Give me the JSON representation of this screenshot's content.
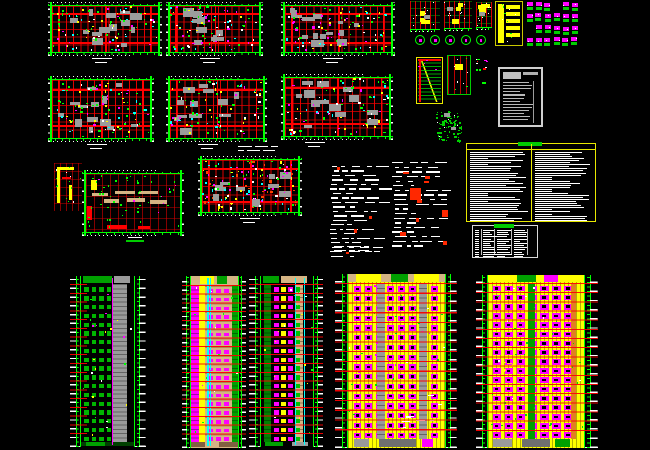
{
  "app": {
    "name": "cad-drawing-sheet",
    "description": "architectural CAD sheet: residential floor plans, detail drawings, schedule tables and five high-rise building elevations on black model space",
    "canvas_bg": "#000000",
    "canvas_width": 650,
    "canvas_height": 450
  },
  "palette": {
    "red": "#ff0000",
    "green": "#00ff00",
    "dark_green": "#008000",
    "magenta": "#ff00ff",
    "yellow": "#ffff00",
    "cyan": "#00ffff",
    "white": "#ffffff",
    "gray": "#9a9a9a",
    "tan": "#d4b483",
    "orange": "#e08020"
  },
  "sheet": {
    "blocks": [
      {
        "id": "floor-plan-1",
        "type": "plan",
        "x": 48,
        "y": 2,
        "w": 114,
        "h": 64,
        "seed": 11,
        "cols": 15,
        "rows": 6,
        "blobs": 14,
        "speckles": 85,
        "title": {
          "dx": 40
        }
      },
      {
        "id": "floor-plan-2",
        "type": "plan",
        "x": 166,
        "y": 2,
        "w": 97,
        "h": 64,
        "seed": 12,
        "cols": 13,
        "rows": 6,
        "blobs": 12,
        "speckles": 75,
        "title": {
          "dx": 30
        }
      },
      {
        "id": "floor-plan-3",
        "type": "plan",
        "x": 281,
        "y": 2,
        "w": 114,
        "h": 64,
        "seed": 13,
        "cols": 15,
        "rows": 6,
        "blobs": 14,
        "speckles": 85,
        "title": {
          "dx": 38
        }
      },
      {
        "id": "floor-plan-4",
        "type": "plan",
        "x": 48,
        "y": 76,
        "w": 106,
        "h": 76,
        "seed": 14,
        "cols": 14,
        "rows": 7,
        "blobs": 13,
        "speckles": 90,
        "title": {
          "dx": 35
        }
      },
      {
        "id": "floor-plan-5",
        "type": "plan",
        "x": 166,
        "y": 76,
        "w": 101,
        "h": 76,
        "seed": 15,
        "cols": 13,
        "rows": 7,
        "blobs": 12,
        "speckles": 80,
        "title": {
          "dx": 28
        }
      },
      {
        "id": "floor-plan-6",
        "type": "plan",
        "x": 281,
        "y": 74,
        "w": 112,
        "h": 76,
        "seed": 16,
        "cols": 14,
        "rows": 7,
        "blobs": 13,
        "speckles": 85,
        "title": {
          "dx": 20
        }
      },
      {
        "id": "roof-plan",
        "type": "roofplan",
        "x": 82,
        "y": 170,
        "w": 102,
        "h": 76,
        "seed": 17,
        "title": {
          "dx": 40,
          "green": true
        }
      },
      {
        "id": "floor-plan-7",
        "type": "plan",
        "x": 198,
        "y": 156,
        "w": 104,
        "h": 70,
        "seed": 18,
        "cols": 14,
        "rows": 6,
        "blobs": 10,
        "speckles": 130,
        "speckleColors": [
          "#ff00ff",
          "#00ffff",
          "#ffff00",
          "#00ff00",
          "#ffffff",
          "#ff4000"
        ],
        "title": {
          "dx": 38
        }
      },
      {
        "id": "unit-detail",
        "type": "unitdetail",
        "x": 54,
        "y": 163,
        "w": 28,
        "h": 48,
        "seed": 19
      },
      {
        "id": "section-detail-1",
        "type": "section",
        "x": 410,
        "y": 1,
        "w": 30,
        "h": 31,
        "seed": 21
      },
      {
        "id": "section-detail-2",
        "type": "section",
        "x": 444,
        "y": 1,
        "w": 28,
        "h": 30,
        "seed": 22
      },
      {
        "id": "section-detail-3",
        "type": "section",
        "x": 476,
        "y": 2,
        "w": 16,
        "h": 28,
        "seed": 23
      },
      {
        "id": "circle-details",
        "type": "circles",
        "x": 413,
        "y": 33,
        "w": 76,
        "h": 15,
        "seed": 24,
        "n": 5
      },
      {
        "id": "stair-core-detail",
        "type": "ydetail",
        "x": 495,
        "y": 1,
        "w": 28,
        "h": 45,
        "seed": 25
      },
      {
        "id": "connector-details",
        "type": "cluster",
        "x": 526,
        "y": 1,
        "w": 54,
        "h": 48,
        "seed": 26,
        "rows": 4,
        "cols": 6
      },
      {
        "id": "stair-section-detail",
        "type": "stair",
        "x": 416,
        "y": 57,
        "w": 27,
        "h": 47,
        "seed": 27
      },
      {
        "id": "wall-detail",
        "type": "detailB",
        "x": 447,
        "y": 55,
        "w": 24,
        "h": 40,
        "seed": 28
      },
      {
        "id": "misc-marks",
        "type": "smallbits",
        "x": 472,
        "y": 58,
        "w": 20,
        "h": 36,
        "seed": 29
      },
      {
        "id": "core-plan-detail",
        "type": "greencluster",
        "x": 436,
        "y": 111,
        "w": 27,
        "h": 32,
        "seed": 30
      },
      {
        "id": "title-block-table",
        "type": "wtable",
        "x": 498,
        "y": 67,
        "w": 45,
        "h": 60,
        "seed": 31
      },
      {
        "id": "notes-table",
        "type": "ytable",
        "x": 466,
        "y": 143,
        "w": 130,
        "h": 79,
        "seed": 32
      },
      {
        "id": "schedule-table",
        "type": "stable",
        "x": 472,
        "y": 225,
        "w": 66,
        "h": 33,
        "seed": 33
      },
      {
        "id": "spec-text-1",
        "type": "sched",
        "x": 330,
        "y": 166,
        "w": 58,
        "h": 94,
        "seed": 34,
        "rows": 21
      },
      {
        "id": "spec-text-2",
        "type": "sched",
        "x": 392,
        "y": 162,
        "w": 66,
        "h": 88,
        "seed": 35,
        "rows": 19,
        "bigRed": true
      },
      {
        "id": "note-line-1",
        "type": "noterow",
        "x": 238,
        "y": 146,
        "w": 36,
        "h": 8,
        "seed": 36
      },
      {
        "id": "note-line-2",
        "type": "noterow",
        "x": 334,
        "y": 246,
        "w": 54,
        "h": 11,
        "seed": 37
      },
      {
        "id": "elevation-1",
        "type": "elev",
        "x": 70,
        "y": 276,
        "w": 76,
        "h": 171,
        "seed": 41,
        "floors": 18,
        "tickL": 11,
        "tickR": 12,
        "par": 8,
        "baseH": 5,
        "wall": "#000000",
        "cols": 4,
        "win": "#00b400",
        "winL": 0.03,
        "winR": 0.4,
        "winH": 0.5,
        "shafts": [
          {
            "x": 0.6,
            "w": 0.26,
            "c": "#9a9a9a",
            "tex": 1
          }
        ],
        "lines": [
          {
            "x": 0.585,
            "c": "#ff00ff"
          }
        ],
        "redSpan": "left",
        "parapet": [
          {
            "x": 0.04,
            "w": 0.55,
            "c": "#00a000"
          },
          {
            "x": 0.62,
            "w": 0.3,
            "c": "#9a9a9a"
          }
        ],
        "base": [
          {
            "x": 0,
            "w": 1,
            "c": "#004000"
          },
          {
            "x": 0.1,
            "w": 0.35,
            "c": "#00a000"
          }
        ],
        "speck": 25,
        "speckColors": [
          "#ffff00",
          "#ff00ff",
          "#ffffff",
          "#00ff00"
        ]
      },
      {
        "id": "elevation-2",
        "type": "elev",
        "x": 182,
        "y": 276,
        "w": 64,
        "h": 172,
        "seed": 42,
        "floors": 18,
        "tickL": 9,
        "tickR": 8,
        "par": 9,
        "baseH": 6,
        "wall": "#d4b483",
        "band": "#b08850",
        "bandH": 2,
        "cols": 3,
        "win": "#ff00ff",
        "winL": 0.33,
        "winR": 0.15,
        "winH": 0.42,
        "shafts": [
          {
            "x": 0.01,
            "w": 0.15,
            "c": "#ff00ff",
            "tex": 1
          },
          {
            "x": 0.17,
            "w": 0.13,
            "c": "#ffff00"
          },
          {
            "x": 0.87,
            "w": 0.13,
            "c": "#00a000",
            "tex": 1
          }
        ],
        "lines": [
          {
            "x": 0.35,
            "c": "#00ffff"
          },
          {
            "x": 0.41,
            "c": "#00ffff"
          }
        ],
        "parapet": [
          {
            "x": 0,
            "w": 1,
            "c": "#d4b483"
          },
          {
            "x": 0.2,
            "w": 0.3,
            "c": "#ffff00"
          },
          {
            "x": 0.55,
            "w": 0.22,
            "c": "#00a000"
          }
        ],
        "base": [
          {
            "x": 0,
            "w": 1,
            "c": "#806040"
          },
          {
            "x": 0.3,
            "w": 0.3,
            "c": "#d4b483"
          }
        ],
        "speck": 20,
        "speckColors": [
          "#00ff00",
          "#ffffff",
          "#ff00ff"
        ]
      },
      {
        "id": "elevation-3",
        "type": "elev",
        "x": 249,
        "y": 276,
        "w": 74,
        "h": 171,
        "seed": 43,
        "floors": 18,
        "tickL": 12,
        "tickR": 10,
        "par": 8,
        "baseH": 5,
        "wall": "#000000",
        "cols": 4,
        "colColors": [
          "#ff00ff",
          "#ffff00",
          "#ff00ff",
          "#00c000"
        ],
        "winL": 0.23,
        "winR": 0.23,
        "winH": 0.5,
        "shafts": [
          {
            "x": 0.06,
            "w": 0.14,
            "c": "#008000",
            "tex": 1
          },
          {
            "x": 0.67,
            "w": 0.13,
            "c": "#d4b483",
            "tex": 1
          }
        ],
        "lines": [
          {
            "x": 0.645,
            "c": "#00ffff"
          },
          {
            "x": 0.82,
            "c": "#00ffff"
          }
        ],
        "parapet": [
          {
            "x": 0.04,
            "w": 0.3,
            "c": "#00a000"
          },
          {
            "x": 0.38,
            "w": 0.5,
            "c": "#d4b483"
          }
        ],
        "base": [
          {
            "x": 0.08,
            "w": 0.35,
            "c": "#00a000"
          },
          {
            "x": 0.6,
            "w": 0.3,
            "c": "#9a9a9a"
          }
        ],
        "speck": 22,
        "speckColors": [
          "#00ff00",
          "#ffffff",
          "#ffff00"
        ]
      },
      {
        "id": "elevation-4",
        "type": "elev",
        "x": 335,
        "y": 274,
        "w": 122,
        "h": 174,
        "seed": 44,
        "floors": 16,
        "tickL": 13,
        "tickR": 12,
        "par": 9,
        "baseH": 9,
        "wall": "#ffff00",
        "wallTex": 1,
        "cols": 8,
        "win": "#ff00ff",
        "winInner": "#000000",
        "winL": 0.04,
        "winR": 0.05,
        "winH": 0.55,
        "shafts": [
          {
            "x": 0.3,
            "w": 0.08,
            "c": "#9a9a9a",
            "over": 1,
            "tex": 1
          },
          {
            "x": 0.73,
            "w": 0.08,
            "c": "#9a9a9a",
            "over": 1,
            "tex": 1
          }
        ],
        "lines": [],
        "parapet": [
          {
            "x": 0,
            "w": 1,
            "c": "#d4b483"
          },
          {
            "x": 0.08,
            "w": 0.26,
            "c": "#ffff00"
          },
          {
            "x": 0.44,
            "w": 0.18,
            "c": "#00a000"
          },
          {
            "x": 0.68,
            "w": 0.26,
            "c": "#ffff00"
          }
        ],
        "base": [
          {
            "x": 0.06,
            "w": 0.16,
            "c": "#9a9a9a"
          },
          {
            "x": 0.32,
            "w": 0.38,
            "c": "#6f6f6f"
          },
          {
            "x": 0.76,
            "w": 0.12,
            "c": "#ff00ff"
          }
        ],
        "whiteNotes": true,
        "speck": 30,
        "speckColors": [
          "#00e000",
          "#00e000",
          "#ffffff",
          "#ff00ff"
        ]
      },
      {
        "id": "elevation-5",
        "type": "elev",
        "x": 476,
        "y": 275,
        "w": 122,
        "h": 173,
        "seed": 45,
        "floors": 17,
        "tickL": 12,
        "tickR": 14,
        "par": 8,
        "baseH": 9,
        "wall": "#ffff00",
        "wallTex": 1,
        "cols": 7,
        "cellF": 0.7,
        "win": "#ff00ff",
        "winInner": "#000000",
        "winL": 0.03,
        "winR": 0.1,
        "winH": 0.6,
        "shafts": [
          {
            "x": 0.42,
            "w": 0.07,
            "c": "#00a000",
            "over": 1
          },
          {
            "x": 0.865,
            "w": 0.05,
            "c": "#e08020",
            "over": 1
          }
        ],
        "lines": [],
        "parapet": [
          {
            "x": 0,
            "w": 1,
            "c": "#ffff00"
          },
          {
            "x": 0.3,
            "w": 0.2,
            "c": "#00a000"
          },
          {
            "x": 0.58,
            "w": 0.15,
            "c": "#ff00ff"
          }
        ],
        "base": [
          {
            "x": 0.05,
            "w": 0.2,
            "c": "#9a9a9a"
          },
          {
            "x": 0.35,
            "w": 0.3,
            "c": "#6f6f6f"
          },
          {
            "x": 0.7,
            "w": 0.15,
            "c": "#00a000"
          }
        ],
        "ydots": true,
        "speck": 35,
        "speckColors": [
          "#00e000",
          "#00e000",
          "#ffffff"
        ]
      }
    ]
  }
}
